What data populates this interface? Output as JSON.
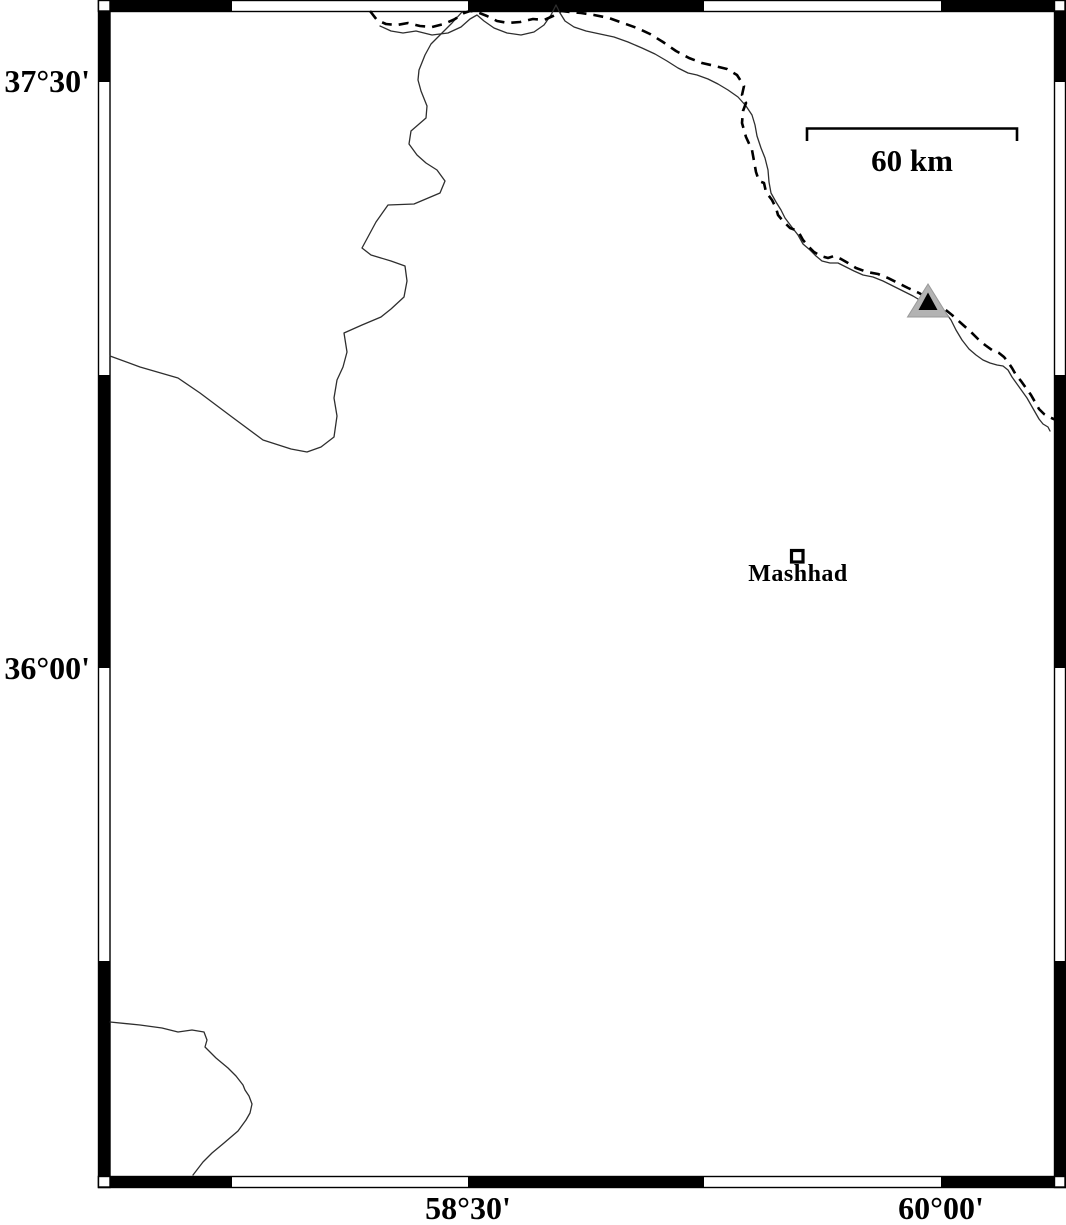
{
  "map": {
    "kind": "location-map",
    "axes": {
      "left": [
        {
          "label": "37°30'"
        },
        {
          "label": "36°00'"
        }
      ],
      "bottom": [
        {
          "label": "58°30'"
        },
        {
          "label": "60°00'"
        }
      ]
    },
    "scale_bar": {
      "label": "60 km",
      "length_km": 60
    },
    "places": {
      "city": {
        "name": "Mashhad",
        "marker": "open-square"
      }
    },
    "markers": {
      "station": {
        "shape": "filled-triangle",
        "fill": "#b3b3b3",
        "core": "#000000"
      }
    },
    "lines": {
      "international_border": {
        "style": "dashed",
        "color": "#000000"
      },
      "rivers": {
        "style": "solid-thin",
        "color": "#2e2e2e"
      }
    },
    "colors": {
      "background": "#ffffff",
      "frame_ink": "#000000",
      "frame_fill_alt": "#ffffff"
    }
  }
}
